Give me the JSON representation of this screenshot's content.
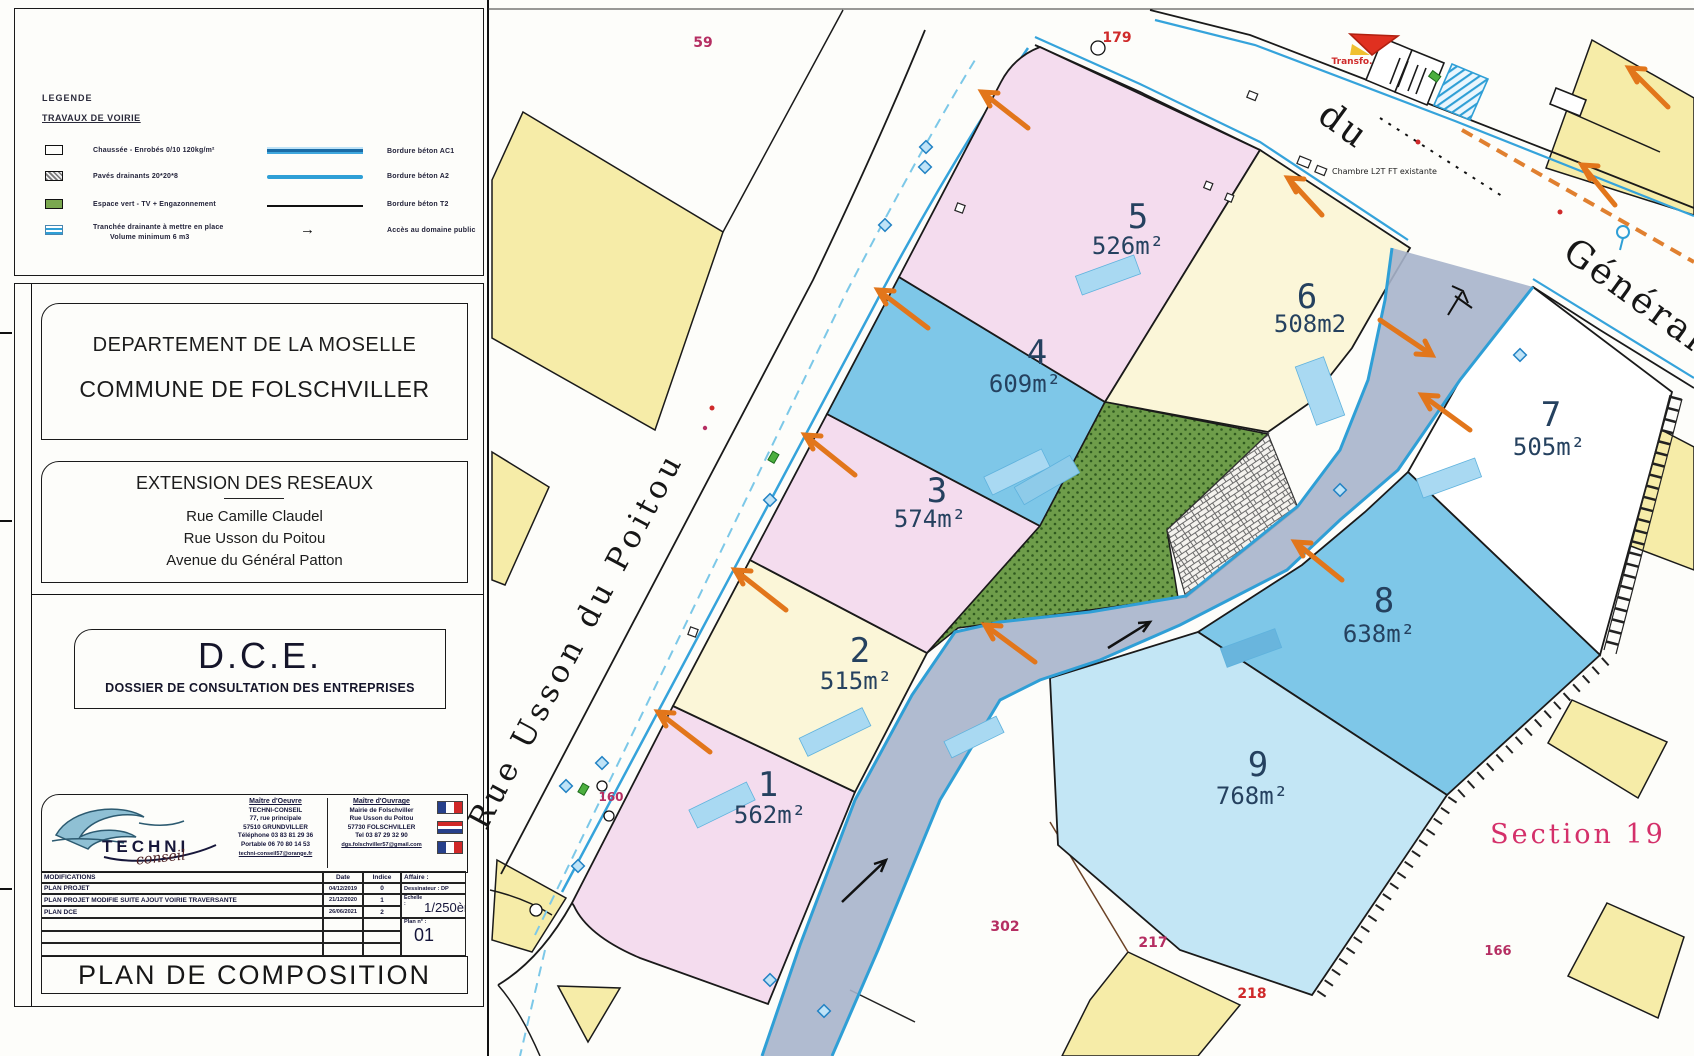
{
  "legend": {
    "title": "LEGENDE",
    "subtitle": "TRAVAUX DE VOIRIE",
    "arrow_glyph": "→",
    "items_left": [
      {
        "label": "Chaussée - Enrobés 0/10 120kg/m²"
      },
      {
        "label": "Pavés drainants 20*20*8"
      },
      {
        "label": "Espace vert - TV + Engazonnement"
      },
      {
        "label": "Tranchée drainante à mettre en place",
        "label2": "Volume minimum 6 m3"
      }
    ],
    "items_right": [
      {
        "label": "Bordure béton AC1"
      },
      {
        "label": "Bordure béton A2"
      },
      {
        "label": "Bordure béton T2"
      },
      {
        "label": "Accès au domaine public"
      }
    ]
  },
  "title_block": {
    "department": "DEPARTEMENT DE LA MOSELLE",
    "commune": "COMMUNE DE FOLSCHVILLER",
    "project": "EXTENSION DES RESEAUX",
    "street1": "Rue Camille Claudel",
    "street2": "Rue Usson du Poitou",
    "street3": "Avenue du Général Patton",
    "dce": "D.C.E.",
    "dce_sub": "DOSSIER DE CONSULTATION DES ENTREPRISES",
    "logo_text": "TECHNI",
    "logo_sub": "conseil",
    "moe": {
      "role": "Maître d'Oeuvre",
      "name": "TECHNI-CONSEIL",
      "addr1": "77, rue principale",
      "addr2": "57510 GRUNDVILLER",
      "tel": "Téléphone 03 83 81 29 36",
      "mobile": "Portable 06 70 80 14 53",
      "email": "techni-conseil57@orange.fr"
    },
    "moa": {
      "role": "Maître d'Ouvrage",
      "name": "Mairie de Folschviller",
      "addr1": "Rue Usson du Poitou",
      "addr2": "57730 FOLSCHVILLER",
      "tel": "Tel 03 87 29 32 90",
      "email": "dgs.folschviller57@gmail.com"
    },
    "table": {
      "modifications": "MODIFICATIONS",
      "date": "Date",
      "indice": "Indice",
      "affaire": "Affaire :",
      "rows": [
        {
          "label": "PLAN PROJET",
          "date": "04/12/2019",
          "indice": "0"
        },
        {
          "label": "PLAN PROJET MODIFIE SUITE AJOUT VOIRIE TRAVERSANTE",
          "date": "21/12/2020",
          "indice": "1"
        },
        {
          "label": "PLAN DCE",
          "date": "26/06/2021",
          "indice": "2"
        }
      ],
      "dessinateur": "Dessinateur : DP",
      "echelle_label": "Echelle :",
      "echelle": "1/250ème",
      "plan_no_label": "Plan n° :",
      "plan_no": "01"
    },
    "sheet_title": "PLAN DE COMPOSITION"
  },
  "map": {
    "street_usson": "Rue Usson du Poitou",
    "avenue_word1": "du",
    "avenue_word2": "Général",
    "section_label": "Section 19",
    "transfo_label": "Transfo.",
    "chambre_label": "Chambre L2T FT existante",
    "parcels": [
      {
        "num": "1",
        "area": "562m²"
      },
      {
        "num": "2",
        "area": "515m²"
      },
      {
        "num": "3",
        "area": "574m²"
      },
      {
        "num": "4",
        "area": "609m²"
      },
      {
        "num": "5",
        "area": "526m²"
      },
      {
        "num": "6",
        "area": "508m2"
      },
      {
        "num": "7",
        "area": "505m²"
      },
      {
        "num": "8",
        "area": "638m²"
      },
      {
        "num": "9",
        "area": "768m²"
      }
    ],
    "plot_numbers": {
      "n59": "59",
      "n179": "179",
      "n160": "160",
      "n302": "302",
      "n217": "217",
      "n218": "218",
      "n166": "166"
    }
  },
  "colors": {
    "parcel_pink": "#f4dcee",
    "parcel_cream": "#fbf6d8",
    "parcel_blue": "#7ec7e8",
    "parcel_lightblue": "#c3e6f5",
    "green_space": "#6e9d4a",
    "road_fill": "#a7b4cb",
    "context_yellow": "#f6eca8",
    "curb_blue": "#2f9fd6",
    "arrow_orange": "#e2761b",
    "label_magenta": "#b52e62",
    "label_red": "#cf2a2a"
  }
}
